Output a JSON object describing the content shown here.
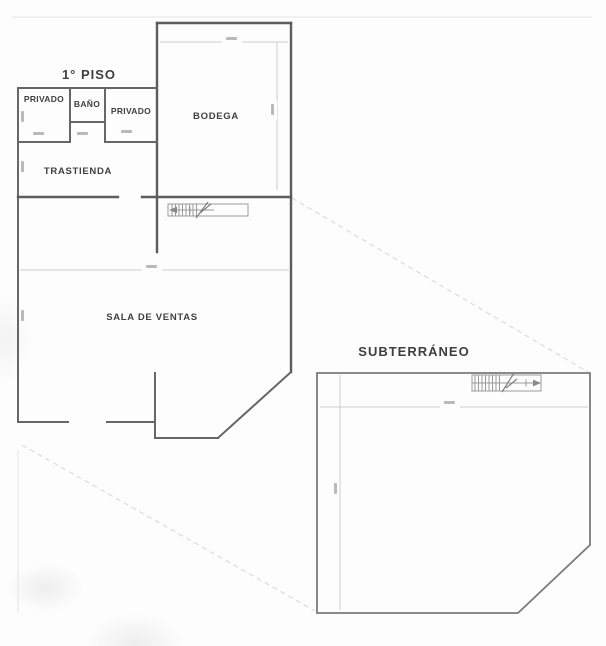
{
  "plan": {
    "first_floor": {
      "title": "1° PISO",
      "room_privado_left": "PRIVADO",
      "room_bano": "BAÑO",
      "room_privado_right": "PRIVADO",
      "room_bodega": "BODEGA",
      "room_trastienda": "TRASTIENDA",
      "room_sala_de_ventas": "SALA DE VENTAS"
    },
    "basement": {
      "title": "SUBTERRÁNEO"
    }
  },
  "colors": {
    "background": "#fdfdfd",
    "wall": "#676767",
    "wall_heavy": "#5d5d5d",
    "basement_wall": "#7a7a7a",
    "stair_line": "#9a9a9a",
    "faint_line": "#cdcdcd",
    "dashed_projection": "#dcdcdc",
    "label_text": "#3f3f3f"
  }
}
